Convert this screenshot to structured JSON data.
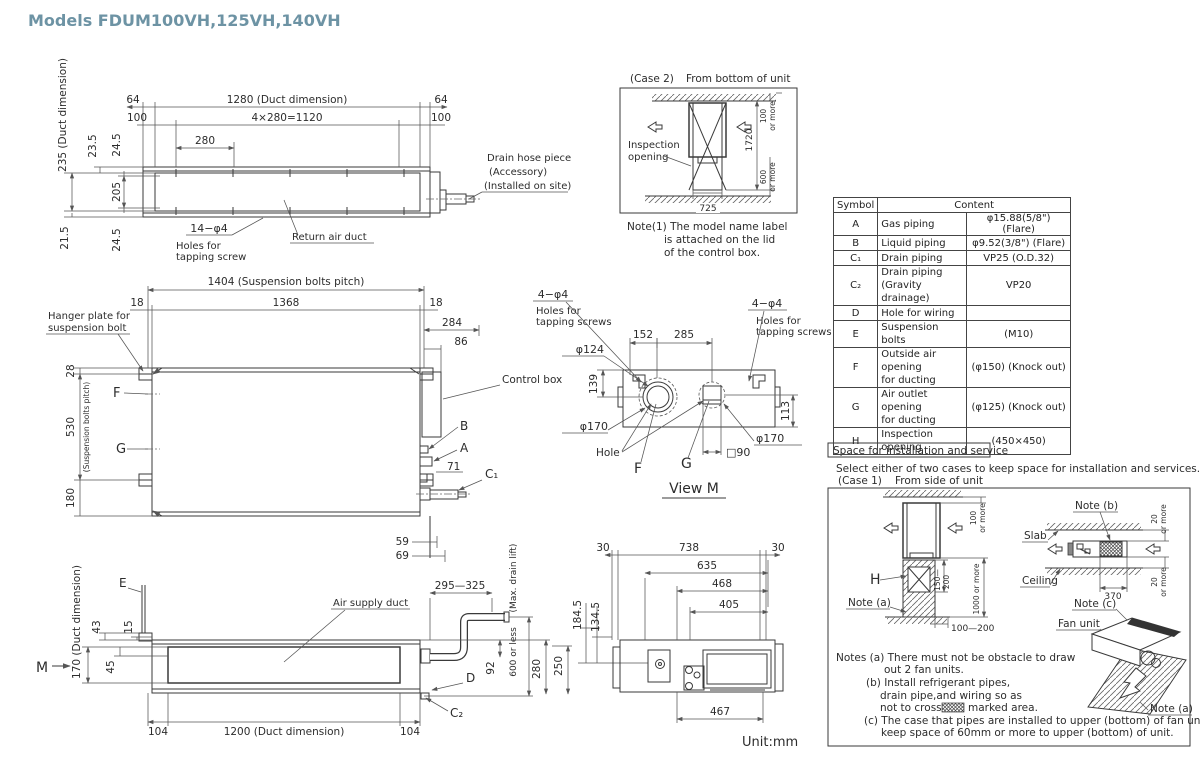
{
  "title": "Models  FDUM100VH,125VH,140VH",
  "unit_label": "Unit:mm",
  "colors": {
    "title_accent": "#6d93a4",
    "line": "#3a3a3a"
  },
  "tv": {
    "d235": "235 (Duct dimension)",
    "d23_5": "23.5",
    "d24_5a": "24.5",
    "d205": "205",
    "d21_5": "21.5",
    "d24_5b": "24.5",
    "d64l": "64",
    "d100l": "100",
    "d1280": "1280 (Duct dimension)",
    "d64r": "64",
    "d100r": "100",
    "d1120": "4×280=1120",
    "d280": "280",
    "holes1": "14−φ4",
    "holes2": "Holes for",
    "holes3": "tapping screw",
    "ret": "Return air duct",
    "dh1": "Drain hose piece",
    "dh2": "(Accessory)",
    "dh3": "(Installed on site)"
  },
  "c2": {
    "case": "(Case 2)",
    "from": "From bottom of unit",
    "insp1": "Inspection",
    "insp2": "opening",
    "d1720": "1720",
    "d100": "100",
    "m1": "or more",
    "d600": "600",
    "m2": "or more",
    "d725": "725",
    "n1": "Note(1)  The model name label",
    "n2": "is attached on the lid",
    "n3": "of the control box."
  },
  "tbl": {
    "hs": "Symbol",
    "hc": "Content",
    "rows": [
      {
        "s": "A",
        "n": "Gas piping",
        "n2": "",
        "v": "φ15.88(5/8\") (Flare)"
      },
      {
        "s": "B",
        "n": "Liquid piping",
        "n2": "",
        "v": "φ9.52(3/8\") (Flare)"
      },
      {
        "s": "C₁",
        "n": "Drain piping",
        "n2": "",
        "v": "VP25 (O.D.32)"
      },
      {
        "s": "C₂",
        "n": "Drain piping",
        "n2": "(Gravity drainage)",
        "v": "VP20"
      },
      {
        "s": "D",
        "n": "Hole for wiring",
        "n2": "",
        "v": ""
      },
      {
        "s": "E",
        "n": "Suspension bolts",
        "n2": "",
        "v": "(M10)"
      },
      {
        "s": "F",
        "n": "Outside air opening",
        "n2": "for ducting",
        "v": "(φ150) (Knock out)"
      },
      {
        "s": "G",
        "n": "Air outlet opening",
        "n2": "for ducting",
        "v": "(φ125) (Knock out)"
      },
      {
        "s": "H",
        "n": "Inspection opening",
        "n2": "",
        "v": "(450×450)"
      }
    ]
  },
  "fv": {
    "d1404": "1404 (Suspension bolts pitch)",
    "d18l": "18",
    "d1368": "1368",
    "d18r": "18",
    "d284": "284",
    "d86": "86",
    "hang1": "Hanger plate for",
    "hang2": "suspension bolt",
    "d28": "28",
    "d530": "530",
    "sbp": "(Suspension bolts pitch)",
    "d180": "180",
    "F": "F",
    "G": "G",
    "cbox": "Control box",
    "B": "B",
    "A": "A",
    "d71": "71",
    "C1": "C₁",
    "d59": "59",
    "d69": "69"
  },
  "vm": {
    "h1a": "4−φ4",
    "h1b": "Holes for",
    "h1c": "tapping screws",
    "h2a": "4−φ4",
    "h2b": "Holes for",
    "h2c": "tapping screws",
    "d152": "152",
    "d285": "285",
    "d124": "φ124",
    "d139": "139",
    "d170l": "φ170",
    "d170r": "φ170",
    "d113": "113",
    "hole": "Hole",
    "F": "F",
    "G": "G",
    "d90": "□90",
    "title": "View M"
  },
  "sv": {
    "E": "E",
    "d170": "170 (Duct dimension)",
    "d43": "43",
    "d15": "15",
    "d45": "45",
    "M": "M",
    "asd": "Air supply duct",
    "d104l": "104",
    "d1200": "1200 (Duct dimension)",
    "d104r": "104",
    "d295": "295—325",
    "mx1": "(Max. drain lift)",
    "mx2": "600 or less",
    "d92": "92",
    "D": "D",
    "C2": "C₂",
    "d280": "280",
    "d250": "250",
    "d184": "184.5",
    "d134": "134.5",
    "d30l": "30",
    "d738": "738",
    "d30r": "30",
    "d635": "635",
    "d468": "468",
    "d405": "405",
    "d467": "467"
  },
  "sp": {
    "title": "Space for installation and service",
    "intro": "Select either of two cases to keep space for installation and services.",
    "case1": "(Case 1)",
    "sub": "From side of unit",
    "d100": "100",
    "m1": "or more",
    "H": "H",
    "na1": "Note (a)",
    "d150": "150—",
    "d200": "200",
    "d1000": "1000 or more",
    "d100200": "100—200",
    "nb": "Note (b)",
    "slab": "Slab",
    "ceil": "Ceiling",
    "d20a": "20",
    "m2": "or more",
    "d20b": "20",
    "m3": "or more",
    "d370": "370",
    "nc": "Note (c)",
    "fan": "Fan unit",
    "na2": "Note (a)",
    "l1": "Notes (a)  There must not be obstacle to draw",
    "l2": "out 2 fan units.",
    "l3": "(b)  Install refrigerant pipes,",
    "l4": "drain pipe,and wiring so as",
    "l5a": "not to cross",
    "l5b": "marked area.",
    "l6": "(c)  The case that pipes are installed to upper (bottom) of fan unit,",
    "l7": "keep space of 60mm or more to upper (bottom) of unit."
  }
}
